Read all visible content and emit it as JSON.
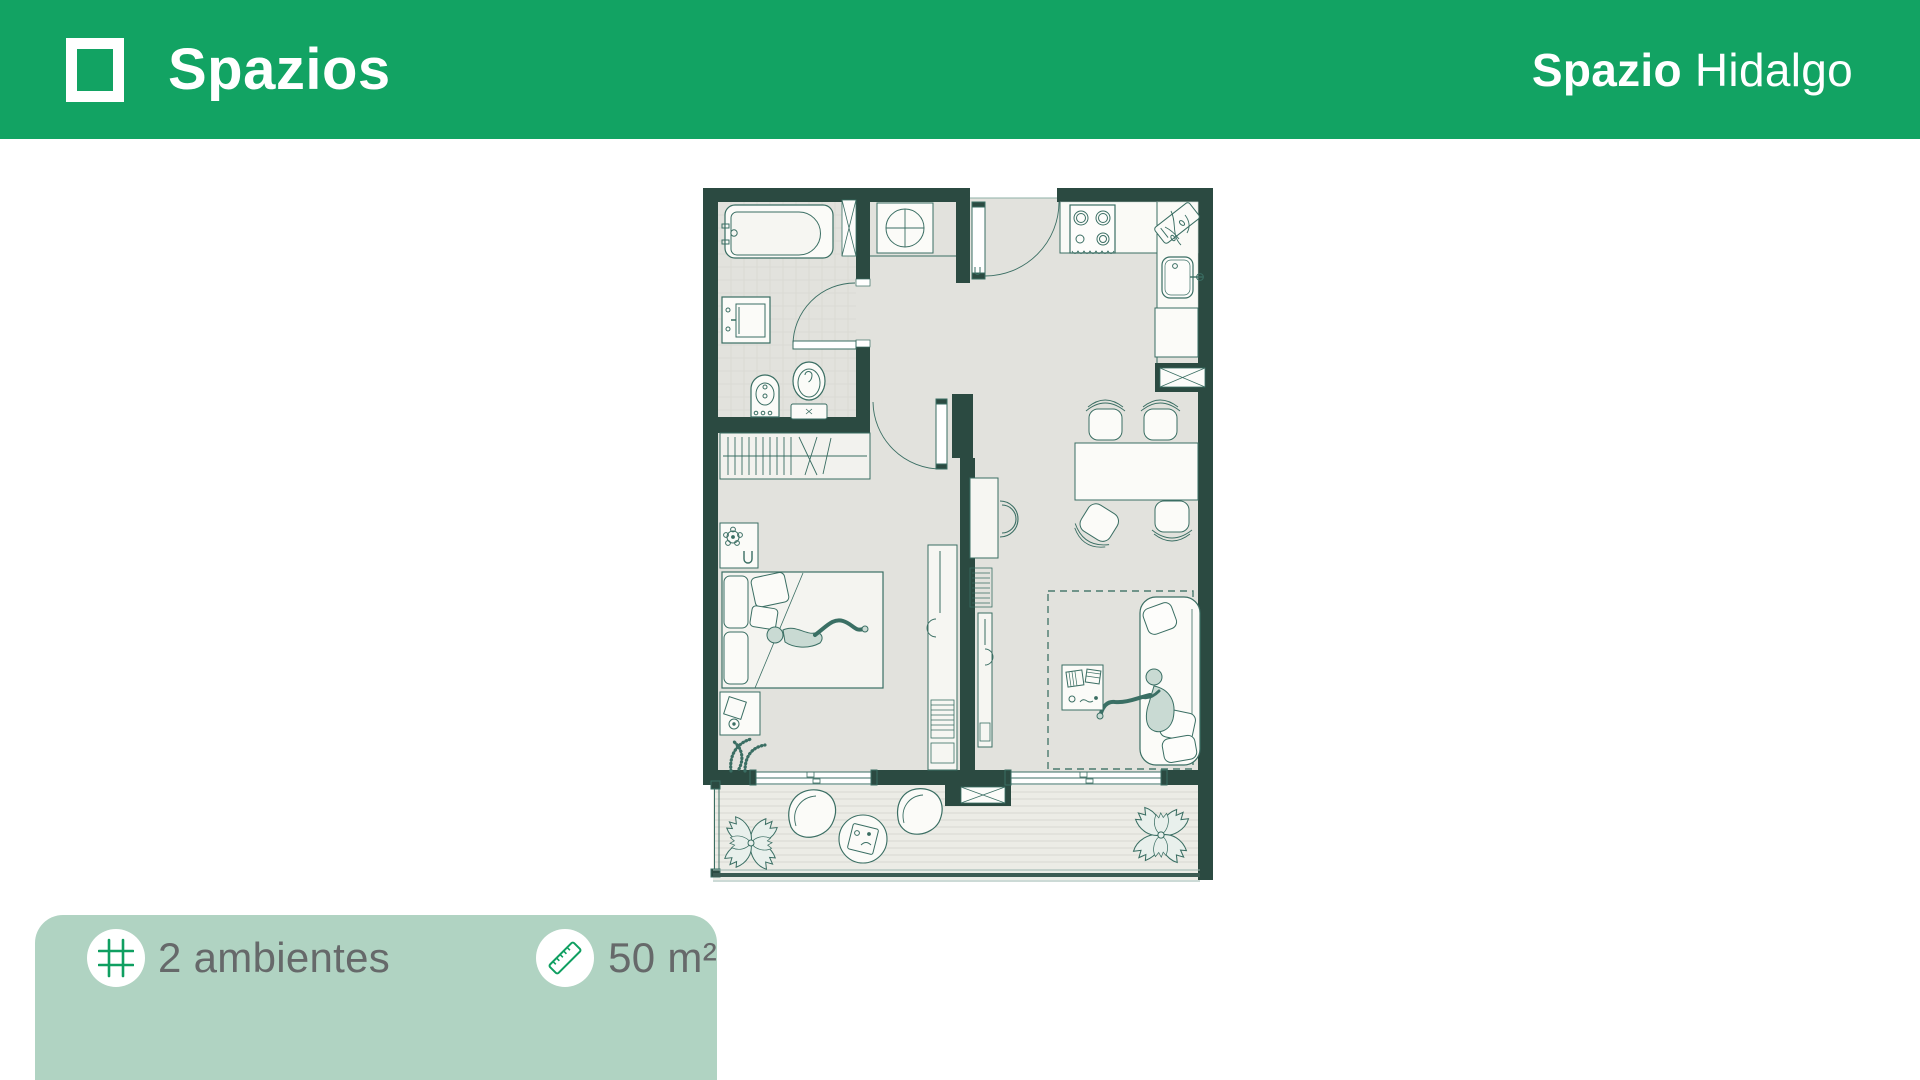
{
  "header": {
    "brand": {
      "logo_icon": "square-outline-logo",
      "name": "Spazios"
    },
    "project": {
      "name_bold": "Spazio",
      "name_light": "Hidalgo"
    }
  },
  "floorplan": {
    "description": "Apartment floor plan, 2 rooms with balcony",
    "rooms": [
      "bathroom",
      "laundry-closet",
      "kitchen",
      "entry-hall",
      "bedroom",
      "living-dining",
      "balcony"
    ],
    "furniture_icons": [
      "bathtub",
      "vanity-sink",
      "bidet",
      "toilet",
      "washing-machine",
      "shaft-x",
      "entry-door",
      "stove",
      "kitchen-sink",
      "cutting-board",
      "dining-table",
      "dining-chairs",
      "wardrobe",
      "nightstand",
      "double-bed",
      "person-lying",
      "media-unit",
      "desk-chair",
      "sofa",
      "person-sitting",
      "coffee-table",
      "rug",
      "sliding-doors",
      "balcony-chairs",
      "balcony-table",
      "plants"
    ]
  },
  "info_card": {
    "items": [
      {
        "icon": "grid-hash-icon",
        "label": "2 ambientes"
      },
      {
        "icon": "ruler-icon",
        "label": "50 m²"
      }
    ]
  },
  "colors": {
    "header_green": "#12a363",
    "card_bg": "#b0d3c2",
    "icon_green": "#0f9f61",
    "label_gray": "#66696a",
    "wall_green": "#2b4a41",
    "floor_gray": "#e2e2dd",
    "balcony_floor": "#ECECE6",
    "plan_line": "#3a6e63",
    "white": "#ffffff"
  }
}
